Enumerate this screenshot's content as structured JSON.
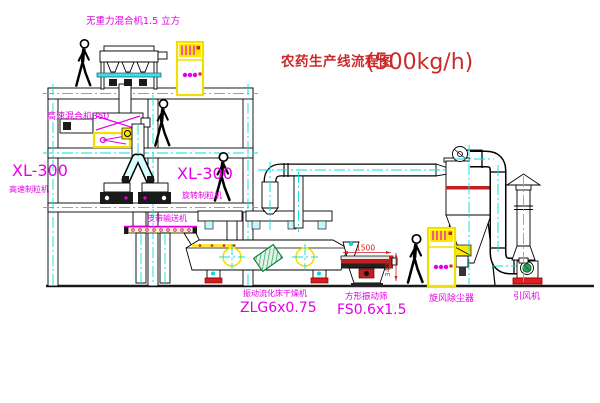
{
  "drawing": {
    "title": "农药生产线流程图",
    "capacity": "(500kg/h)"
  },
  "labels": {
    "gravity_free_mixer": "无重力混合机1.5 立方",
    "high_speed_mixer": "高速混合机350",
    "granulator_left_model": "XL-300",
    "granulator_left_name": "高速制粒机",
    "granulator_right_model": "XL-300",
    "granulator_right_name": "旋转制粒机",
    "belt_conveyor": "皮带输送机",
    "dryer_name": "振动流化床干燥机",
    "dryer_model": "ZLG6x0.75",
    "screen_name": "方形振动筛",
    "screen_model": "FS0.6x1.5",
    "cyclone": "旋风除尘器",
    "fan": "引风机"
  },
  "dimensions": {
    "screen_length": "1500",
    "screen_height": "340"
  },
  "colors": {
    "label_magenta": "#e400e4",
    "title_red": "#cb2a2a",
    "centerline_cyan": "#00e0e0",
    "equipment_yellow": "#ffe900",
    "dimension_red": "#d22020",
    "motor_green": "#2aa05a"
  }
}
